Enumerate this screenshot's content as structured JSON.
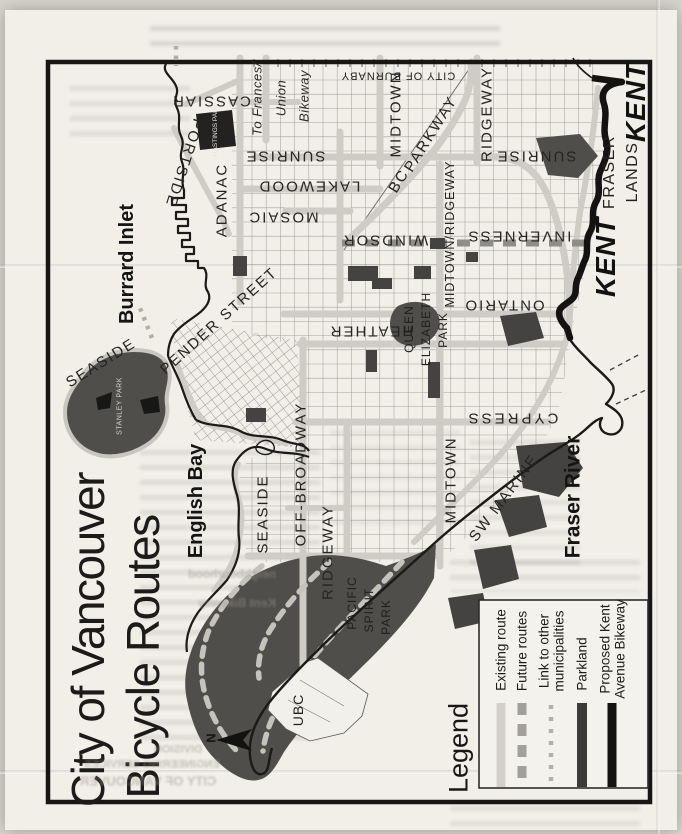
{
  "title": {
    "line1": "City of Vancouver",
    "line2": "Bicycle Routes"
  },
  "water": {
    "burrard_inlet": "Burrard Inlet",
    "english_bay": "English Bay",
    "fraser_river": "Fraser River"
  },
  "places": {
    "kent": "KENT",
    "fraser": "FRASER",
    "lands": "LANDS",
    "city_of_burnaby": "CITY OF BURNABY",
    "ubc": "UBC",
    "pacific": "PACIFIC",
    "spirit": "SPIRIT",
    "park": "PARK",
    "queen": "QUEEN",
    "elizabeth": "ELIZABETH",
    "hastings": "HASTINGS PARK",
    "stanley": "STANLEY PARK"
  },
  "routes": {
    "seaside": "SEASIDE",
    "portside": "PORTSIDE",
    "cassiar": "CASSIAR",
    "adanac": "ADANAC",
    "sunrise": "SUNRISE",
    "lakewood": "LAKEWOOD",
    "mosaic": "MOSAIC",
    "windsor": "WINDSOR",
    "inverness": "INVERNESS",
    "ontario": "ONTARIO",
    "heather": "HEATHER",
    "cypress": "CYPRESS",
    "midtown": "MIDTOWN",
    "ridgeway": "RIDGEWAY",
    "midtown_ridgeway": "MIDTOWN/RIDGEWAY",
    "off_broadway": "OFF-BROADWAY",
    "sw_marine": "SW MARINE",
    "bc": "BC",
    "parkway": "PARKWAY",
    "pender_street": "PENDER STREET",
    "to_frances_line1": "To Frances/",
    "to_frances_line2": "Union",
    "to_frances_line3": "Bikeway"
  },
  "legend": {
    "title": "Legend",
    "existing": "Existing route",
    "future": "Future routes",
    "link_line1": "Link to other",
    "link_line2": "municipalities",
    "parkland": "Parkland",
    "kent_line1": "Proposed Kent",
    "kent_line2": "Avenue Bikeway"
  },
  "compass": {
    "north": "N"
  },
  "bleedthrough": {
    "line1": "CITY OF VANCOUVER",
    "line2": "ENGINEERING SERVICES",
    "line3": "DIVISION",
    "line4": "Kent Bikeway",
    "line5": "neighbourhood"
  },
  "colors": {
    "paper": "#f1efe8",
    "route_existing": "#cfccc6",
    "route_future": "#8f8d87",
    "route_link": "#b1aea8",
    "parkland": "#504e4b",
    "kent_bikeway": "#141312",
    "frame": "#171615"
  }
}
